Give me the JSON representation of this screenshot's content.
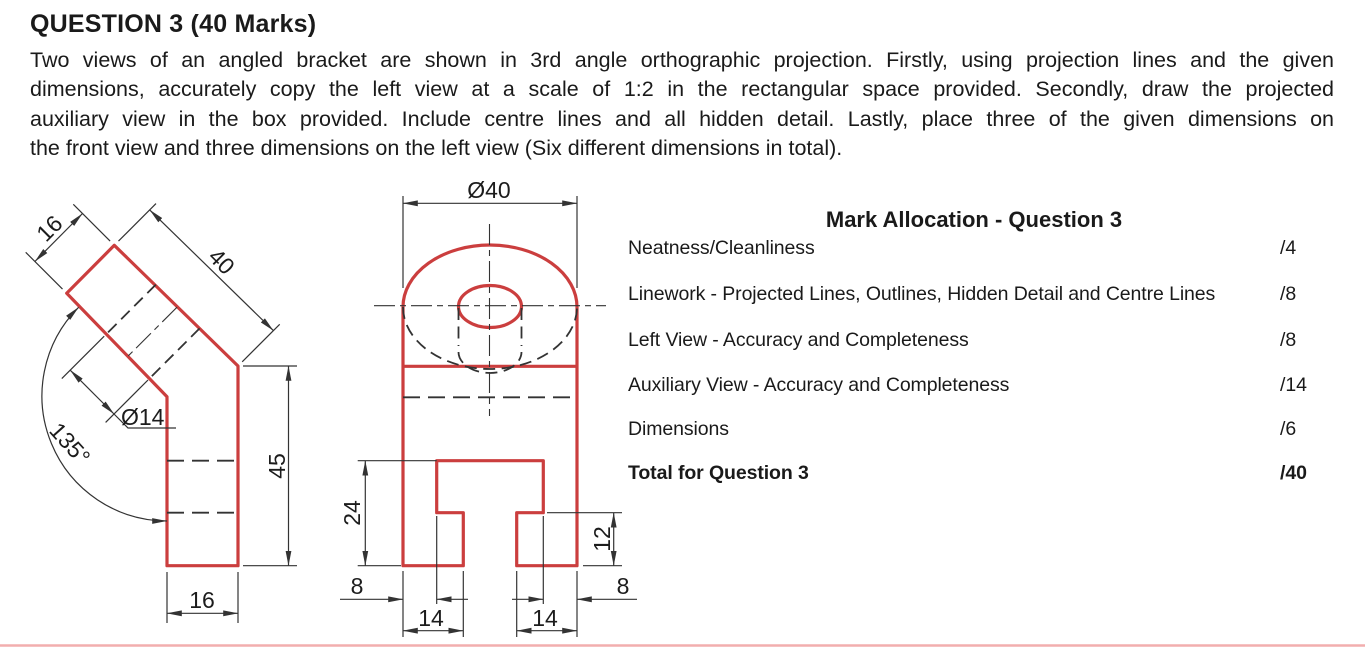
{
  "header": {
    "title": "QUESTION 3 (40 Marks)"
  },
  "intro": {
    "lines": [
      "Two views of an angled bracket are shown in 3rd angle orthographic projection. Firstly, using projection lines and the given",
      "dimensions, accurately copy the left view at a scale of 1:2 in the rectangular space provided. Secondly, draw the projected",
      "auxiliary view in the box provided. Include centre lines and all hidden detail. Lastly, place three of the given dimensions on",
      "the front view and three dimensions on the left view (Six different dimensions in total)."
    ]
  },
  "left_view": {
    "dims": {
      "top_width": "16",
      "arm_length": "40",
      "hole_diameter": "Ø14",
      "bend_angle": "135°",
      "column_height": "45",
      "base_width": "16"
    }
  },
  "front_view": {
    "dims": {
      "overall_diameter": "Ø40",
      "slot_depth": "24",
      "left_edge_to_slot": "8",
      "left_foot_width": "14",
      "right_foot_width": "14",
      "step_height": "12",
      "right_edge_to_slot": "8"
    }
  },
  "marks_table": {
    "title": "Mark Allocation - Question 3",
    "rows": [
      {
        "label": "Neatness/Cleanliness",
        "score": "/4"
      },
      {
        "label": "Linework - Projected Lines, Outlines, Hidden Detail and Centre Lines",
        "score": "/8"
      },
      {
        "label": "Left View - Accuracy and Completeness",
        "score": "/8"
      },
      {
        "label": "Auxiliary View - Accuracy and Completeness",
        "score": "/14"
      },
      {
        "label": "Dimensions",
        "score": "/6"
      },
      {
        "label": "Total for Question 3",
        "score": "/40"
      }
    ]
  },
  "colors": {
    "outline": "#cb3e3e",
    "linework": "#333333",
    "page_rule": "#f2aeae"
  }
}
